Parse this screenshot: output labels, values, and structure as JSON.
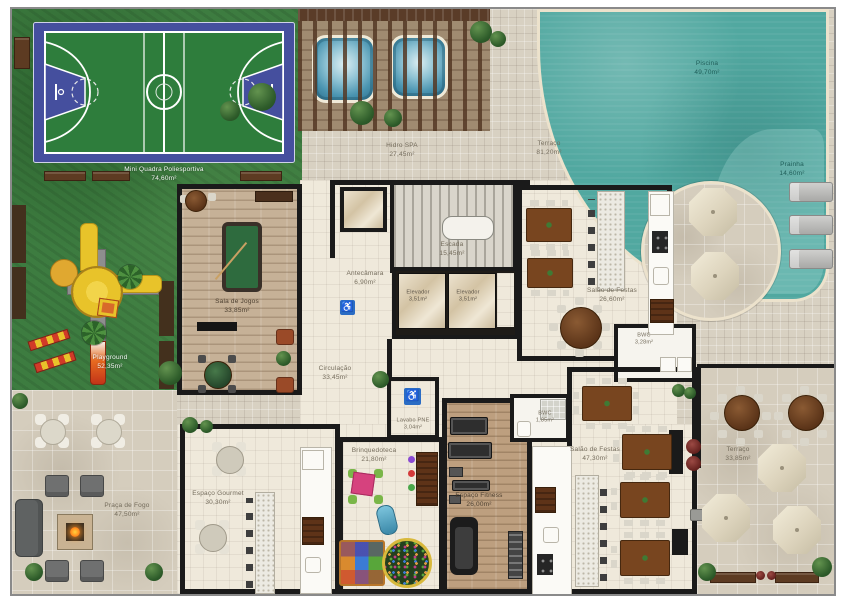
{
  "rooms": {
    "quadra": {
      "name": "Mini Quadra Poliesportiva",
      "area": "74,60m²"
    },
    "playground": {
      "name": "Playground",
      "area": "52,35m²"
    },
    "hidro_spa": {
      "name": "Hidro SPA",
      "area": "27,45m²"
    },
    "terraco_superior": {
      "name": "Terraço",
      "area": "81,20m²"
    },
    "piscina": {
      "name": "Piscina",
      "area": "49,70m²"
    },
    "prainha": {
      "name": "Prainha",
      "area": "14,60m²"
    },
    "escada": {
      "name": "Escada",
      "area": "15,45m²"
    },
    "antecamara": {
      "name": "Antecâmara",
      "area": "6,90m²"
    },
    "elevador_1": {
      "name": "Elevador",
      "area": "3,51m²"
    },
    "elevador_2": {
      "name": "Elevador",
      "area": "3,51m²"
    },
    "sala_de_jogos": {
      "name": "Sala de Jogos",
      "area": "33,85m²"
    },
    "salao_de_festas_1": {
      "name": "Salão de Festas",
      "area": "26,60m²"
    },
    "bwc_1": {
      "name": "BWC",
      "area": "3,28m²"
    },
    "circulacao": {
      "name": "Circulação",
      "area": "33,45m²"
    },
    "lavabo_pne": {
      "name": "Lavabo PNE",
      "area": "3,04m²"
    },
    "brinquedoteca": {
      "name": "Brinquedoteca",
      "area": "21,80m²"
    },
    "espaco_gourmet": {
      "name": "Espaço Gourmet",
      "area": "30,30m²"
    },
    "espaco_fitness": {
      "name": "Espaço Fitness",
      "area": "26,00m²"
    },
    "bwc_2": {
      "name": "BWC",
      "area": "1,85m²"
    },
    "salao_de_festas_2": {
      "name": "Salão de Festas",
      "area": "47,30m²"
    },
    "terraco_lateral": {
      "name": "Terraço",
      "area": "33,85m²"
    },
    "praca_de_fogo": {
      "name": "Praça de Fogo",
      "area": "47,50m²"
    }
  },
  "signs": {
    "accessible_glyph": "♿"
  },
  "palette": {
    "grass": "#3d7c40",
    "water": "#51a8a0",
    "court_blue": "#454f9e",
    "court_green": "#2e7d3c",
    "deck_tile": "#d8d1c2",
    "interior_floor": "#efe9db",
    "wall": "#1a1a1a",
    "wood_floor": "#c6b197",
    "table_wood": "#78451f"
  }
}
